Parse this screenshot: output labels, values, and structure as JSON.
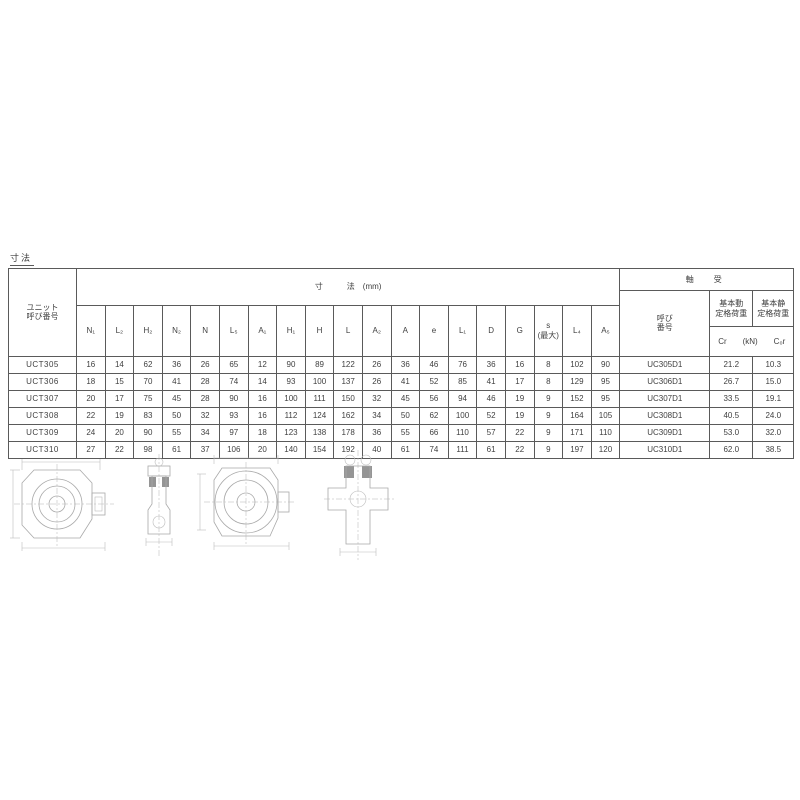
{
  "page": {
    "top_label": "寸法"
  },
  "table": {
    "unit_col_header": "ユニット\n呼び番号",
    "dim_group_header": "寸　　　法　(mm)",
    "dim_headers": [
      "N₁",
      "L₂",
      "H₂",
      "N₂",
      "N",
      "L₅",
      "A₁",
      "H₁",
      "H",
      "L",
      "A₂",
      "A",
      "e",
      "L₁",
      "D",
      "G",
      "s\n(最大)",
      "L₄",
      "A₅"
    ],
    "bearing_group_header": "軸　受",
    "bearing_no_header": "呼び\n番号",
    "dynamic_rating_header": "基本動\n定格荷重",
    "static_rating_header": "基本静\n定格荷重",
    "rating_sub": {
      "cr": "Cr",
      "unit": "(kN)",
      "cor": "C₀r"
    },
    "rows": [
      {
        "unit": "UCT305",
        "dims": [
          "16",
          "14",
          "62",
          "36",
          "26",
          "65",
          "12",
          "90",
          "89",
          "122",
          "26",
          "36",
          "46",
          "76",
          "36",
          "16",
          "8",
          "102",
          "90"
        ],
        "bearing": "UC305D1",
        "cr": "21.2",
        "cor": "10.3"
      },
      {
        "unit": "UCT306",
        "dims": [
          "18",
          "15",
          "70",
          "41",
          "28",
          "74",
          "14",
          "93",
          "100",
          "137",
          "26",
          "41",
          "52",
          "85",
          "41",
          "17",
          "8",
          "129",
          "95"
        ],
        "bearing": "UC306D1",
        "cr": "26.7",
        "cor": "15.0"
      },
      {
        "unit": "UCT307",
        "dims": [
          "20",
          "17",
          "75",
          "45",
          "28",
          "90",
          "16",
          "100",
          "111",
          "150",
          "32",
          "45",
          "56",
          "94",
          "46",
          "19",
          "9",
          "152",
          "95"
        ],
        "bearing": "UC307D1",
        "cr": "33.5",
        "cor": "19.1"
      },
      {
        "unit": "UCT308",
        "dims": [
          "22",
          "19",
          "83",
          "50",
          "32",
          "93",
          "16",
          "112",
          "124",
          "162",
          "34",
          "50",
          "62",
          "100",
          "52",
          "19",
          "9",
          "164",
          "105"
        ],
        "bearing": "UC308D1",
        "cr": "40.5",
        "cor": "24.0"
      },
      {
        "unit": "UCT309",
        "dims": [
          "24",
          "20",
          "90",
          "55",
          "34",
          "97",
          "18",
          "123",
          "138",
          "178",
          "36",
          "55",
          "66",
          "110",
          "57",
          "22",
          "9",
          "171",
          "110"
        ],
        "bearing": "UC309D1",
        "cr": "53.0",
        "cor": "32.0"
      },
      {
        "unit": "UCT310",
        "dims": [
          "27",
          "22",
          "98",
          "61",
          "37",
          "106",
          "20",
          "140",
          "154",
          "192",
          "40",
          "61",
          "74",
          "111",
          "61",
          "22",
          "9",
          "197",
          "120"
        ],
        "bearing": "UC310D1",
        "cr": "62.0",
        "cor": "38.5"
      }
    ]
  },
  "drawings": {
    "front_view_label": "take-up-unit-front-view",
    "side_view_label": "take-up-unit-side-view",
    "front_view2_label": "take-up-unit-front-view-2",
    "section_view_label": "take-up-unit-section-view"
  },
  "colors": {
    "text": "#3f3f3f",
    "table_border": "#5a5a5a",
    "drawing_line": "#a9a9a9",
    "background": "#ffffff"
  }
}
